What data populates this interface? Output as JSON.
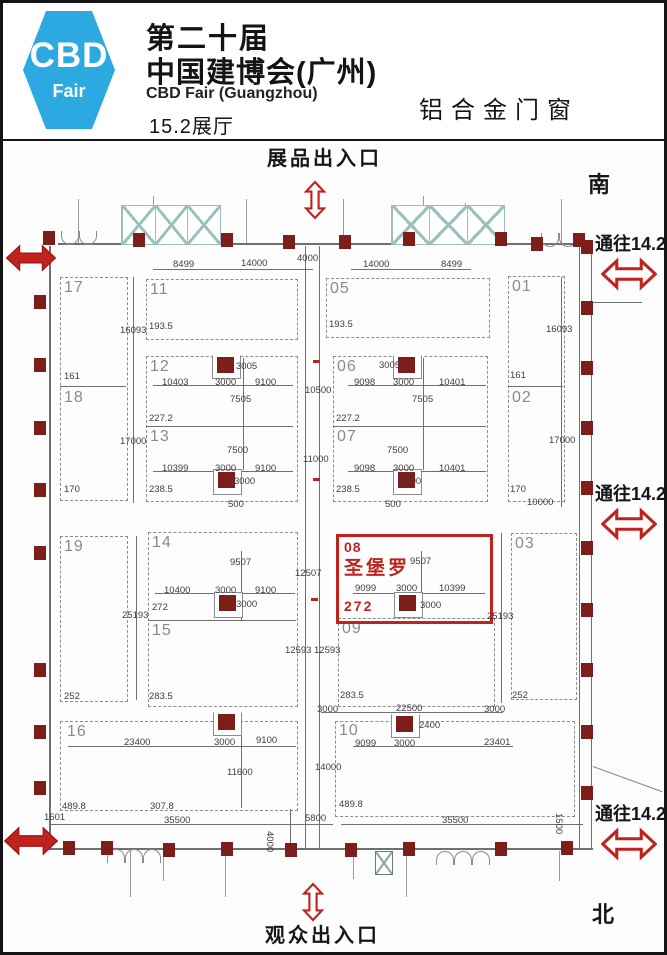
{
  "header": {
    "logo_line1": "CBD",
    "logo_line2": "Fair",
    "logo_color": "#2ba9e0",
    "title_line1": "第二十届",
    "title_line2": "中国建博会(广州)",
    "subtitle": "CBD Fair (Guangzhou)",
    "hall": "15.2展厅",
    "category": "铝合金门窗"
  },
  "signs": {
    "exhibit_entrance": "展品出入口",
    "visitor_entrance": "观众出入口",
    "to_142_top": "通往14.2",
    "to_142_mid": "通往14.2",
    "to_142_bottom": "通往14.2",
    "south": "南",
    "north": "北"
  },
  "highlight": {
    "booth_no": "08",
    "brand": "圣堡罗",
    "area": "272",
    "color": "#c0231d"
  },
  "plan": {
    "booths": [
      {
        "id": "17",
        "box": [
          57,
          274,
          66,
          222
        ],
        "lx": 61,
        "ly": 276
      },
      {
        "id": "18",
        "lx": 61,
        "ly": 386
      },
      {
        "id": "11",
        "box": [
          143,
          276,
          150,
          59
        ],
        "lx": 147,
        "ly": 278
      },
      {
        "id": "05",
        "box": [
          323,
          275,
          162,
          58
        ],
        "lx": 327,
        "ly": 277
      },
      {
        "id": "01",
        "box": [
          505,
          273,
          55,
          224
        ],
        "lx": 509,
        "ly": 275
      },
      {
        "id": "02",
        "lx": 509,
        "ly": 386
      },
      {
        "id": "12",
        "box": [
          143,
          353,
          150,
          144
        ],
        "lx": 147,
        "ly": 355
      },
      {
        "id": "13",
        "lx": 147,
        "ly": 425
      },
      {
        "id": "06",
        "box": [
          330,
          353,
          153,
          144
        ],
        "lx": 334,
        "ly": 355
      },
      {
        "id": "07",
        "lx": 334,
        "ly": 425
      },
      {
        "id": "19",
        "box": [
          57,
          533,
          66,
          164
        ],
        "lx": 61,
        "ly": 535
      },
      {
        "id": "14",
        "box": [
          145,
          529,
          148,
          173
        ],
        "lx": 149,
        "ly": 531
      },
      {
        "id": "15",
        "lx": 149,
        "ly": 619
      },
      {
        "id": "09",
        "box": [
          335,
          615,
          155,
          87
        ],
        "lx": 339,
        "ly": 617
      },
      {
        "id": "03",
        "box": [
          508,
          530,
          64,
          165
        ],
        "lx": 512,
        "ly": 532
      },
      {
        "id": "16",
        "box": [
          57,
          718,
          236,
          88
        ],
        "lx": 64,
        "ly": 720
      },
      {
        "id": "10",
        "box": [
          332,
          718,
          238,
          94
        ],
        "lx": 336,
        "ly": 719
      }
    ],
    "dims": [
      {
        "t": "8499",
        "x": 170,
        "y": 256
      },
      {
        "t": "14000",
        "x": 238,
        "y": 255
      },
      {
        "t": "4000",
        "x": 294,
        "y": 250
      },
      {
        "t": "14000",
        "x": 360,
        "y": 256
      },
      {
        "t": "8499",
        "x": 438,
        "y": 256
      },
      {
        "t": "193.5",
        "x": 146,
        "y": 318
      },
      {
        "t": "193.5",
        "x": 326,
        "y": 316
      },
      {
        "t": "16093",
        "x": 117,
        "y": 322
      },
      {
        "t": "16093",
        "x": 543,
        "y": 321
      },
      {
        "t": "161",
        "x": 61,
        "y": 368
      },
      {
        "t": "161",
        "x": 507,
        "y": 367
      },
      {
        "t": "170",
        "x": 61,
        "y": 481
      },
      {
        "t": "170",
        "x": 507,
        "y": 481
      },
      {
        "t": "17000",
        "x": 117,
        "y": 433
      },
      {
        "t": "17000",
        "x": 546,
        "y": 432
      },
      {
        "t": "10000",
        "x": 524,
        "y": 494
      },
      {
        "t": "3005",
        "x": 233,
        "y": 358
      },
      {
        "t": "10403",
        "x": 159,
        "y": 374
      },
      {
        "t": "3000",
        "x": 212,
        "y": 374
      },
      {
        "t": "9100",
        "x": 252,
        "y": 374
      },
      {
        "t": "7505",
        "x": 227,
        "y": 391
      },
      {
        "t": "227.2",
        "x": 146,
        "y": 410
      },
      {
        "t": "7500",
        "x": 224,
        "y": 442
      },
      {
        "t": "10399",
        "x": 159,
        "y": 460
      },
      {
        "t": "3000",
        "x": 212,
        "y": 460
      },
      {
        "t": "9100",
        "x": 252,
        "y": 460
      },
      {
        "t": "3000",
        "x": 231,
        "y": 473
      },
      {
        "t": "238.5",
        "x": 146,
        "y": 481
      },
      {
        "t": "500",
        "x": 225,
        "y": 496
      },
      {
        "t": "3005",
        "x": 376,
        "y": 357
      },
      {
        "t": "9098",
        "x": 351,
        "y": 374
      },
      {
        "t": "3000",
        "x": 390,
        "y": 374
      },
      {
        "t": "10401",
        "x": 436,
        "y": 374
      },
      {
        "t": "10500",
        "x": 302,
        "y": 382
      },
      {
        "t": "7505",
        "x": 409,
        "y": 391
      },
      {
        "t": "227.2",
        "x": 333,
        "y": 410
      },
      {
        "t": "7500",
        "x": 384,
        "y": 442
      },
      {
        "t": "9098",
        "x": 351,
        "y": 460
      },
      {
        "t": "3000",
        "x": 390,
        "y": 460
      },
      {
        "t": "10401",
        "x": 436,
        "y": 460
      },
      {
        "t": "11000",
        "x": 300,
        "y": 451
      },
      {
        "t": "3000",
        "x": 397,
        "y": 473
      },
      {
        "t": "238.5",
        "x": 333,
        "y": 481
      },
      {
        "t": "500",
        "x": 382,
        "y": 496
      },
      {
        "t": "9507",
        "x": 227,
        "y": 554
      },
      {
        "t": "12507",
        "x": 292,
        "y": 565
      },
      {
        "t": "10400",
        "x": 161,
        "y": 582
      },
      {
        "t": "3000",
        "x": 212,
        "y": 582
      },
      {
        "t": "9100",
        "x": 252,
        "y": 582
      },
      {
        "t": "272",
        "x": 149,
        "y": 599
      },
      {
        "t": "3000",
        "x": 233,
        "y": 596
      },
      {
        "t": "25193",
        "x": 119,
        "y": 607
      },
      {
        "t": "12593",
        "x": 282,
        "y": 642
      },
      {
        "t": "12593",
        "x": 311,
        "y": 642
      },
      {
        "t": "283.5",
        "x": 146,
        "y": 688
      },
      {
        "t": "252",
        "x": 61,
        "y": 688
      },
      {
        "t": "9507",
        "x": 407,
        "y": 553
      },
      {
        "t": "9099",
        "x": 352,
        "y": 580
      },
      {
        "t": "3000",
        "x": 393,
        "y": 580
      },
      {
        "t": "10399",
        "x": 436,
        "y": 580
      },
      {
        "t": "3000",
        "x": 417,
        "y": 597
      },
      {
        "t": "25193",
        "x": 484,
        "y": 608
      },
      {
        "t": "283.5",
        "x": 337,
        "y": 687
      },
      {
        "t": "252",
        "x": 509,
        "y": 687
      },
      {
        "t": "3000",
        "x": 314,
        "y": 701
      },
      {
        "t": "22500",
        "x": 393,
        "y": 700
      },
      {
        "t": "3000",
        "x": 481,
        "y": 701
      },
      {
        "t": "2400",
        "x": 416,
        "y": 717
      },
      {
        "t": "23400",
        "x": 121,
        "y": 734
      },
      {
        "t": "3000",
        "x": 211,
        "y": 734
      },
      {
        "t": "9100",
        "x": 253,
        "y": 732
      },
      {
        "t": "9099",
        "x": 352,
        "y": 735
      },
      {
        "t": "3000",
        "x": 391,
        "y": 735
      },
      {
        "t": "23401",
        "x": 481,
        "y": 734
      },
      {
        "t": "11600",
        "x": 224,
        "y": 764
      },
      {
        "t": "14000",
        "x": 312,
        "y": 759
      },
      {
        "t": "489.8",
        "x": 59,
        "y": 798
      },
      {
        "t": "307.8",
        "x": 147,
        "y": 798
      },
      {
        "t": "489.8",
        "x": 336,
        "y": 796
      },
      {
        "t": "1601",
        "x": 41,
        "y": 809
      },
      {
        "t": "35500",
        "x": 161,
        "y": 812
      },
      {
        "t": "4000",
        "x": 272,
        "y": 828,
        "r": 90
      },
      {
        "t": "5800",
        "x": 302,
        "y": 810
      },
      {
        "t": "35500",
        "x": 439,
        "y": 812
      },
      {
        "t": "1500",
        "x": 561,
        "y": 810,
        "r": 90
      }
    ],
    "lines": [
      [
        55,
        240,
        531,
        2
      ],
      [
        46,
        243,
        2,
        604
      ],
      [
        46,
        845,
        544,
        2
      ],
      [
        576,
        243,
        1,
        604
      ],
      [
        588,
        250,
        1,
        595
      ],
      [
        57,
        383,
        66,
        1
      ],
      [
        505,
        383,
        55,
        1
      ],
      [
        143,
        423,
        147,
        1
      ],
      [
        330,
        423,
        153,
        1
      ],
      [
        145,
        617,
        148,
        1
      ],
      [
        150,
        266,
        160,
        1
      ],
      [
        348,
        266,
        120,
        1
      ],
      [
        150,
        382,
        140,
        1
      ],
      [
        345,
        382,
        138,
        1
      ],
      [
        150,
        468,
        140,
        1
      ],
      [
        345,
        468,
        138,
        1
      ],
      [
        152,
        590,
        140,
        1
      ],
      [
        350,
        590,
        132,
        1
      ],
      [
        318,
        709,
        182,
        1
      ],
      [
        65,
        743,
        228,
        1
      ],
      [
        350,
        743,
        160,
        1
      ],
      [
        48,
        821,
        282,
        1
      ],
      [
        338,
        821,
        242,
        1
      ],
      [
        130,
        274,
        1,
        226
      ],
      [
        558,
        274,
        1,
        230
      ],
      [
        302,
        243,
        1,
        602
      ],
      [
        316,
        243,
        1,
        602
      ],
      [
        133,
        533,
        1,
        164
      ],
      [
        498,
        530,
        1,
        170
      ],
      [
        240,
        355,
        1,
        112
      ],
      [
        420,
        355,
        1,
        112
      ],
      [
        238,
        548,
        1,
        69
      ],
      [
        418,
        548,
        1,
        44
      ],
      [
        238,
        718,
        1,
        87
      ],
      [
        589,
        299,
        50,
        1
      ],
      [
        287,
        806,
        1,
        42
      ]
    ],
    "columns": {
      "notch": [
        [
          214,
          354
        ],
        [
          395,
          354
        ],
        [
          215,
          711
        ],
        [
          393,
          713
        ]
      ],
      "boxed": [
        [
          215,
          469
        ],
        [
          395,
          469
        ],
        [
          216,
          592
        ],
        [
          396,
          592
        ]
      ]
    },
    "wall_columns": [
      [
        31,
        292
      ],
      [
        31,
        355
      ],
      [
        31,
        418
      ],
      [
        31,
        480
      ],
      [
        31,
        543
      ],
      [
        31,
        660
      ],
      [
        31,
        722
      ],
      [
        31,
        778
      ],
      [
        578,
        237
      ],
      [
        578,
        298
      ],
      [
        578,
        358
      ],
      [
        578,
        418
      ],
      [
        578,
        478
      ],
      [
        578,
        538
      ],
      [
        578,
        600
      ],
      [
        578,
        660
      ],
      [
        578,
        722
      ],
      [
        578,
        783
      ],
      [
        40,
        228
      ],
      [
        130,
        230
      ],
      [
        218,
        230
      ],
      [
        280,
        232
      ],
      [
        336,
        232
      ],
      [
        400,
        229
      ],
      [
        492,
        229
      ],
      [
        528,
        234
      ],
      [
        570,
        230
      ],
      [
        60,
        838
      ],
      [
        98,
        838
      ],
      [
        160,
        840
      ],
      [
        218,
        839
      ],
      [
        282,
        840
      ],
      [
        342,
        840
      ],
      [
        400,
        839
      ],
      [
        492,
        839
      ],
      [
        558,
        838
      ]
    ],
    "trusses": [
      [
        118,
        202,
        98,
        38
      ],
      [
        388,
        202,
        112,
        38
      ]
    ],
    "sticks": [
      [
        75,
        196,
        44
      ],
      [
        150,
        193,
        47
      ],
      [
        243,
        196,
        44
      ],
      [
        340,
        196,
        44
      ],
      [
        420,
        193,
        47
      ],
      [
        462,
        200,
        40
      ],
      [
        558,
        196,
        44
      ],
      [
        127,
        848,
        46
      ],
      [
        160,
        848,
        30
      ],
      [
        222,
        848,
        46
      ],
      [
        350,
        848,
        28
      ],
      [
        403,
        848,
        46
      ],
      [
        556,
        848,
        30
      ]
    ],
    "arcs_down": [
      [
        58,
        228
      ],
      [
        76,
        228
      ],
      [
        538,
        230
      ],
      [
        556,
        230
      ]
    ],
    "arcs_up": [
      [
        104,
        846
      ],
      [
        122,
        846
      ],
      [
        140,
        846
      ],
      [
        433,
        848
      ],
      [
        451,
        848
      ],
      [
        469,
        848
      ]
    ],
    "xbox": [
      372,
      848,
      16,
      22
    ],
    "marks": [
      [
        310,
        357
      ],
      [
        310,
        475
      ],
      [
        308,
        595
      ]
    ]
  }
}
